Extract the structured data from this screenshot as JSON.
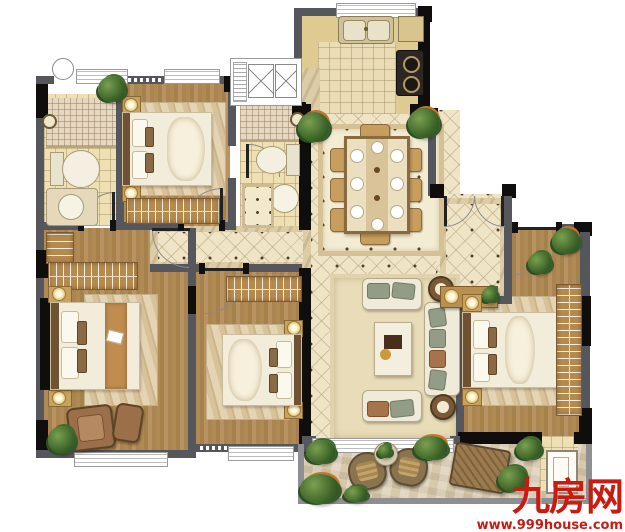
{
  "image_type": "residential-floor-plan",
  "watermark": {
    "brand": "九房网",
    "url": "www.999house.com",
    "color": "#cc1a0e"
  },
  "palette": {
    "wall": "#56575c",
    "column": "#0f0e0c",
    "wood_floor": "#b08a54",
    "tile_floor": "#efe4c5",
    "bath_floor": "#eee0b2",
    "kitchen_counter": "#dfcb92",
    "terrace_floor": "#d8c9ad",
    "rug": "#e9ddb9",
    "wardrobe_wood": "#b58a4e",
    "sofa": "#f0ead8",
    "plant": "#3c6428",
    "watermark_red": "#cc1a0e"
  },
  "rooms": [
    {
      "id": "kitchen",
      "features": [
        "double-basin-sink",
        "gas-cooktop",
        "l-shaped-counter",
        "window"
      ]
    },
    {
      "id": "dining-room",
      "features": [
        "eight-seat-table",
        "place-settings",
        "two-plants",
        "bordered-tile-carpet"
      ]
    },
    {
      "id": "living-room",
      "features": [
        "three-seat-sofa",
        "two-loveseats",
        "coffee-table",
        "two-round-side-tables",
        "area-rug",
        "terrace-window"
      ]
    },
    {
      "id": "entry-hall",
      "features": [
        "double-entry-door",
        "console-table",
        "lamp",
        "plant"
      ]
    },
    {
      "id": "bedroom-top-left",
      "features": [
        "double-bed",
        "two-nightstand-lamps",
        "wardrobe",
        "rug",
        "window",
        "plant"
      ]
    },
    {
      "id": "master-bedroom",
      "features": [
        "double-bed",
        "walkthrough-wardrobe",
        "two-nightstand-lamps",
        "armchair",
        "ottoman",
        "plant",
        "rug",
        "window"
      ]
    },
    {
      "id": "bedroom-bottom-center",
      "features": [
        "double-bed",
        "wardrobe",
        "two-nightstand-lamps",
        "rug",
        "window"
      ]
    },
    {
      "id": "bedroom-right",
      "features": [
        "double-bed",
        "two-nightstand-lamps",
        "full-wall-wardrobe",
        "plants",
        "rug",
        "terrace-door"
      ]
    },
    {
      "id": "bathroom-top-left",
      "features": [
        "mosaic-shower",
        "shower-head",
        "toilet",
        "vanity-basin",
        "window",
        "vent-circle"
      ]
    },
    {
      "id": "bathroom-center",
      "features": [
        "mosaic-shower",
        "shower-head",
        "toilet",
        "pedestal-basin",
        "tile-mat"
      ]
    },
    {
      "id": "ac-platform",
      "features": [
        "two-equipment-x-boxes"
      ]
    },
    {
      "id": "hallway",
      "features": [
        "bordered-diamond-tile",
        "four-door-openings"
      ]
    },
    {
      "id": "terrace",
      "features": [
        "two-lounge-chairs",
        "round-table-with-plant",
        "wooden-sun-lounger",
        "shrubs",
        "low-parapet"
      ]
    }
  ]
}
